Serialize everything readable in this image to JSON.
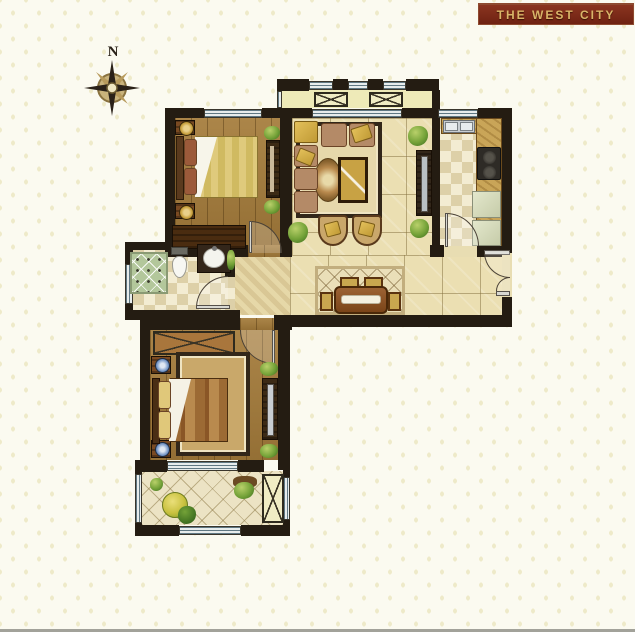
{
  "banner": {
    "title": "THE WEST CITY"
  },
  "compass": {
    "label": "N"
  },
  "palette": {
    "page_background": "#fbfaf0",
    "pattern_dot": "#eeeac9",
    "banner_background": "#7b2a18",
    "banner_text": "#d9b468",
    "wall": "#241c12",
    "wood_floor": "#a57c3b",
    "tile_floor": "#ebdfb2",
    "checker_light": "#f3ecd2",
    "checker_dark": "#ddd0a8",
    "balcony_tile": "#ece3c4",
    "window_glass": "#e7ecec",
    "window_line": "#5f7782",
    "shower_tile": "#b3c79b",
    "sofa_cushion": "#b48a67",
    "gold_accent": "#d8b152",
    "dark_wood": "#3c2a15",
    "plant_green": "#74a238",
    "footer_bar": "#a2a29a"
  },
  "icons": [
    "compass-rose-icon",
    "double-bed-icon",
    "pillow-icon",
    "nightstand-lamp-icon",
    "wardrobe-icon",
    "sofa-icon",
    "armchair-icon",
    "coffee-table-icon",
    "tv-cabinet-icon",
    "rug-icon",
    "dining-table-icon",
    "dining-chair-icon",
    "kitchen-sink-icon",
    "stove-icon",
    "refrigerator-icon",
    "toilet-icon",
    "washbasin-icon",
    "shower-icon",
    "door-swing-icon",
    "window-icon",
    "plant-icon"
  ]
}
